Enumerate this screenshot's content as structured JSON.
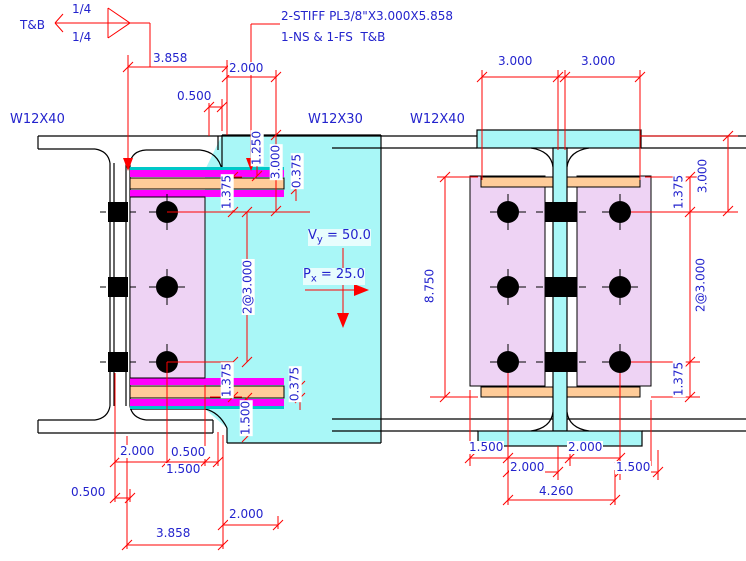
{
  "beam_labels": {
    "left": "W12X40",
    "middle": "W12X30",
    "right": "W12X40"
  },
  "weld_symbol": {
    "location_note": "T&B",
    "top_size": "1/4",
    "bottom_size": "1/4"
  },
  "stiffener_note": {
    "line1": "2-STIFF PL3/8\"X3.000X5.858",
    "line2": "1-NS & 1-FS  T&B"
  },
  "loads": {
    "shear_prefix": "V",
    "shear_sub": "y",
    "shear_value": " = 50.0",
    "axial_prefix": "P",
    "axial_sub": "x",
    "axial_value": " = 25.0"
  },
  "dimensions": {
    "top_left_3858": "3.858",
    "top_left_2000": "2.000",
    "top_left_0500": "0.500",
    "stiff_1250": "1.250",
    "stiff_3000_v": "3.000",
    "stiff_0375_top": "0.375",
    "left_1375_top": "1.375",
    "left_bolt_spacing": "2@3.000",
    "left_1375_bot": "1.375",
    "stiff_0375_bot": "0.375",
    "left_1500_v": "1.500",
    "bot_left_2000": "2.000",
    "bot_left_0500a": "0.500",
    "bot_left_1500": "1.500",
    "bot_left_0500b": "0.500",
    "bot_left_2000b": "2.000",
    "bot_left_3858": "3.858",
    "right_top_3000a": "3.000",
    "right_top_3000b": "3.000",
    "right_8750": "8.750",
    "right_1375_top": "1.375",
    "right_bolt_spacing": "2@3.000",
    "right_1375_bot": "1.375",
    "right_3000_v": "3.000",
    "bot_right_1500a": "1.500",
    "bot_right_2000a": "2.000",
    "bot_right_2000b": "2.000",
    "bot_right_1500b": "1.500",
    "bot_right_4260": "4.260"
  },
  "colors": {
    "dimension_text": "#2323cd",
    "dimension_lines": "#ff0000",
    "weld_plate": "#ff00ff",
    "stiffener_plate": "#ffcc99",
    "shear_plate": "#eed3f4",
    "beam_fill": "#a9f7f7",
    "edge_teal": "#00c8c8",
    "linework": "#000000"
  }
}
